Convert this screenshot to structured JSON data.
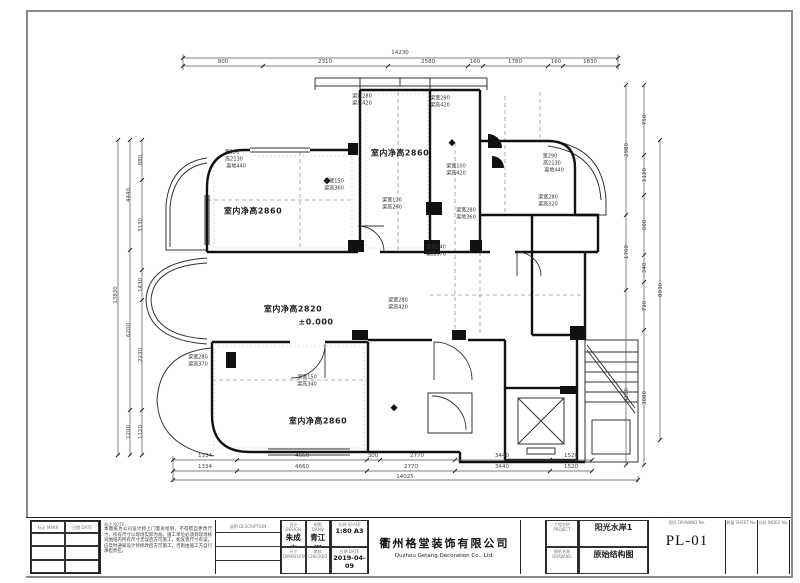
{
  "drawing": {
    "type_label": "原始结构图",
    "project": "阳光水岸1",
    "sheet_no": "PL-01",
    "scale": "1:80 A3",
    "date": "2019-04-09"
  },
  "plan": {
    "texts": [
      {
        "t": "14230",
        "x": 400,
        "y": 53,
        "c": "d"
      },
      {
        "t": "800",
        "x": 223,
        "y": 62,
        "c": "d"
      },
      {
        "t": "2310",
        "x": 325,
        "y": 62,
        "c": "d"
      },
      {
        "t": "2580",
        "x": 428,
        "y": 62,
        "c": "d"
      },
      {
        "t": "160",
        "x": 475,
        "y": 62,
        "c": "d"
      },
      {
        "t": "1780",
        "x": 515,
        "y": 62,
        "c": "d"
      },
      {
        "t": "160",
        "x": 556,
        "y": 62,
        "c": "d"
      },
      {
        "t": "1830",
        "x": 590,
        "y": 62,
        "c": "d"
      },
      {
        "t": "1334",
        "x": 205,
        "y": 456,
        "c": "d"
      },
      {
        "t": "4660",
        "x": 302,
        "y": 456,
        "c": "d"
      },
      {
        "t": "300",
        "x": 373,
        "y": 456,
        "c": "d"
      },
      {
        "t": "2770",
        "x": 417,
        "y": 456,
        "c": "d"
      },
      {
        "t": "3440",
        "x": 502,
        "y": 456,
        "c": "d"
      },
      {
        "t": "1520",
        "x": 571,
        "y": 456,
        "c": "d"
      },
      {
        "t": "1334",
        "x": 205,
        "y": 467,
        "c": "d"
      },
      {
        "t": "4660",
        "x": 302,
        "y": 467,
        "c": "d"
      },
      {
        "t": "2770",
        "x": 411,
        "y": 467,
        "c": "d"
      },
      {
        "t": "3440",
        "x": 502,
        "y": 467,
        "c": "d"
      },
      {
        "t": "1520",
        "x": 571,
        "y": 467,
        "c": "d"
      },
      {
        "t": "14025",
        "x": 405,
        "y": 477,
        "c": "d"
      },
      {
        "t": "13830",
        "x": 116,
        "y": 295,
        "c": "v"
      },
      {
        "t": "4440",
        "x": 129,
        "y": 195,
        "c": "v"
      },
      {
        "t": "6200",
        "x": 129,
        "y": 330,
        "c": "v"
      },
      {
        "t": "1200",
        "x": 129,
        "y": 432,
        "c": "v"
      },
      {
        "t": "880",
        "x": 141,
        "y": 160,
        "c": "v"
      },
      {
        "t": "3130",
        "x": 141,
        "y": 225,
        "c": "v"
      },
      {
        "t": "1430",
        "x": 141,
        "y": 285,
        "c": "v"
      },
      {
        "t": "2230",
        "x": 141,
        "y": 355,
        "c": "v"
      },
      {
        "t": "1120",
        "x": 141,
        "y": 432,
        "c": "v"
      },
      {
        "t": "2980",
        "x": 627,
        "y": 150,
        "c": "v"
      },
      {
        "t": "1700",
        "x": 627,
        "y": 252,
        "c": "v"
      },
      {
        "t": "4180",
        "x": 627,
        "y": 395,
        "c": "v"
      },
      {
        "t": "750",
        "x": 645,
        "y": 120,
        "c": "v"
      },
      {
        "t": "1120",
        "x": 645,
        "y": 175,
        "c": "v"
      },
      {
        "t": "600",
        "x": 645,
        "y": 225,
        "c": "v"
      },
      {
        "t": "340",
        "x": 645,
        "y": 268,
        "c": "v"
      },
      {
        "t": "720",
        "x": 645,
        "y": 306,
        "c": "v"
      },
      {
        "t": "3080",
        "x": 645,
        "y": 398,
        "c": "v"
      },
      {
        "t": "8930",
        "x": 661,
        "y": 290,
        "c": "v"
      },
      {
        "t": "室内净高2860",
        "x": 253,
        "y": 211,
        "c": "r"
      },
      {
        "t": "室内净高2860",
        "x": 400,
        "y": 153,
        "c": "r"
      },
      {
        "t": "室内净高2820",
        "x": 293,
        "y": 309,
        "c": "r"
      },
      {
        "t": "±0.000",
        "x": 316,
        "y": 322,
        "c": "r"
      },
      {
        "t": "室内净高2860",
        "x": 318,
        "y": 421,
        "c": "r"
      },
      {
        "t": "梁宽280",
        "x": 362,
        "y": 96,
        "c": "n"
      },
      {
        "t": "梁高420",
        "x": 362,
        "y": 103,
        "c": "n"
      },
      {
        "t": "梁宽280",
        "x": 440,
        "y": 98,
        "c": "n"
      },
      {
        "t": "梁高420",
        "x": 440,
        "y": 105,
        "c": "n"
      },
      {
        "t": "宽290",
        "x": 232,
        "y": 152,
        "c": "n"
      },
      {
        "t": "高2130",
        "x": 234,
        "y": 159,
        "c": "n"
      },
      {
        "t": "离地440",
        "x": 236,
        "y": 166,
        "c": "n"
      },
      {
        "t": "宽290",
        "x": 550,
        "y": 156,
        "c": "n"
      },
      {
        "t": "高2130",
        "x": 552,
        "y": 163,
        "c": "n"
      },
      {
        "t": "离地440",
        "x": 554,
        "y": 170,
        "c": "n"
      },
      {
        "t": "梁宽280",
        "x": 548,
        "y": 197,
        "c": "n"
      },
      {
        "t": "梁高320",
        "x": 548,
        "y": 204,
        "c": "n"
      },
      {
        "t": "梁宽150",
        "x": 334,
        "y": 181,
        "c": "n"
      },
      {
        "t": "梁高360",
        "x": 334,
        "y": 188,
        "c": "n"
      },
      {
        "t": "梁宽120",
        "x": 392,
        "y": 200,
        "c": "n"
      },
      {
        "t": "梁高260",
        "x": 392,
        "y": 207,
        "c": "n"
      },
      {
        "t": "梁宽100",
        "x": 456,
        "y": 166,
        "c": "n"
      },
      {
        "t": "梁高420",
        "x": 456,
        "y": 173,
        "c": "n"
      },
      {
        "t": "梁宽240",
        "x": 436,
        "y": 247,
        "c": "n"
      },
      {
        "t": "梁高370",
        "x": 436,
        "y": 254,
        "c": "n"
      },
      {
        "t": "梁宽280",
        "x": 398,
        "y": 300,
        "c": "n"
      },
      {
        "t": "梁高420",
        "x": 398,
        "y": 307,
        "c": "n"
      },
      {
        "t": "梁宽280",
        "x": 466,
        "y": 210,
        "c": "n"
      },
      {
        "t": "离地360",
        "x": 466,
        "y": 217,
        "c": "n"
      },
      {
        "t": "梁宽280",
        "x": 198,
        "y": 357,
        "c": "n"
      },
      {
        "t": "梁高370",
        "x": 198,
        "y": 364,
        "c": "n"
      },
      {
        "t": "梁宽150",
        "x": 307,
        "y": 377,
        "c": "n"
      },
      {
        "t": "梁高340",
        "x": 307,
        "y": 384,
        "c": "n"
      }
    ]
  },
  "stickers": [
    {
      "t": "😛",
      "x": 614,
      "y": 524,
      "k": "face"
    },
    {
      "t": "💖",
      "x": 645,
      "y": 520,
      "k": "heart"
    },
    {
      "t": "😛",
      "x": 676,
      "y": 522,
      "k": "face"
    },
    {
      "t": "✨",
      "x": 699,
      "y": 520,
      "k": "heart small"
    },
    {
      "t": "💖",
      "x": 602,
      "y": 547,
      "k": "heart"
    },
    {
      "t": "😛",
      "x": 634,
      "y": 549,
      "k": "face"
    },
    {
      "t": "💖",
      "x": 665,
      "y": 546,
      "k": "heart"
    }
  ],
  "titleblock": {
    "rev_col1": "标记 MARK",
    "rev_col2": "日期 DATE",
    "note_label": "备注 NOTE:",
    "note_text": "本图纸为公司设计师上门量房绘制，不得擅自更改尺寸，所有尺寸以现场实际为准。施工单位必须到现场核对图纸内所有尺寸无误后方可施工，如发现尺寸有误，应及时通知设计师修改后方可施工，否则由施工方自行承担责任。",
    "desc_header": "说明 DESCRIPTION",
    "design_label": "设计 DESIGN",
    "design_name": "朱成杰",
    "draw_label": "制图 DRAW",
    "draw_name": "青江洲",
    "draw_phone": "138 123 5600",
    "dim_label": "尺寸 DIMENSION",
    "check_label": "审核 CHECKED",
    "scale_label": "比例 SCALE",
    "scale_value": "1:80 A3",
    "date_label": "日期 DATE",
    "date_value": "2019-04-09",
    "company_cn": "衢州格堂装饰有限公司",
    "company_en": "Quzhou Getang Decoration Co., Ltd.",
    "project_label": "工程名称 PROJECT",
    "dwg_label": "图纸名称 DRAWING",
    "project_value": "阳光水岸1",
    "dwg_value": "原始结构图",
    "no_label": "图号 DRAWING No.",
    "no_value": "PL-01",
    "sheet_label": "数量 SHEET No.",
    "index_label": "存档 INDEX No."
  }
}
